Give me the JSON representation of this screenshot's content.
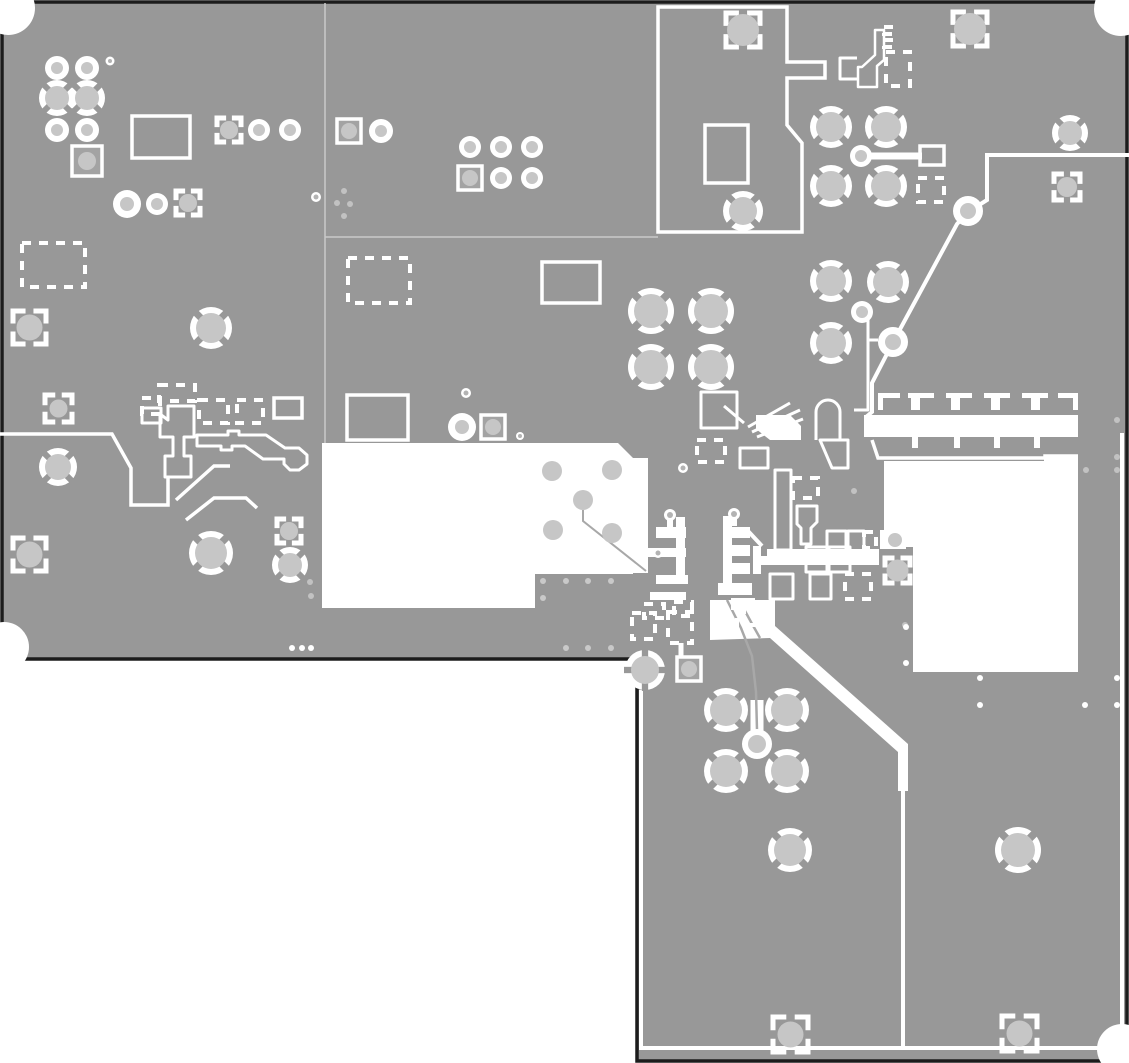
{
  "canvas": {
    "width": 1129,
    "height": 1063
  },
  "colors": {
    "background": "#ffffff",
    "copper": "#989898",
    "edge": "#1c1c1c",
    "white": "#ffffff",
    "padFill": "#c6c6c6",
    "squareFill": "#a3a3a3",
    "dotLight": "#c2c2c2",
    "blockDot": "#c9c9c9",
    "faintLine": "#c9c9c9",
    "grayTrace": "#a8a8a8"
  },
  "board": {
    "outline_path": "M2,2 H1127 V1061 H637 V659 H2 Z",
    "corner_cutouts": [
      {
        "x": 8,
        "y": 8,
        "r": 27
      },
      {
        "x": 1121,
        "y": 9,
        "r": 27
      },
      {
        "x": 4,
        "y": 647,
        "r": 25
      },
      {
        "x": 1122,
        "y": 1049,
        "r": 25
      }
    ],
    "faint_lines": [
      {
        "pts": [
          [
            325,
            3
          ],
          [
            325,
            443
          ]
        ],
        "w": 1.5
      },
      {
        "pts": [
          [
            325,
            237
          ],
          [
            658,
            237
          ]
        ],
        "w": 1.5
      }
    ]
  },
  "white_regions": [
    {
      "d": "M322,443 L618,443 L633,458 L648,458 L648,573 L633,573 L633,574 L535,574 L535,608 L322,608 Z"
    },
    {
      "d": "M884,461 L1044,461 L1044,457 L1078,457 L1078,672 L913,672 L913,547 L884,547 Z"
    },
    {
      "d": "M864,415 L1078,415 L1078,437 L864,437 Z"
    },
    {
      "d": "M710,600 L775,600 L775,626 L908,744 L908,791 L898,791 L898,752 L770,638 L710,640 Z"
    },
    {
      "d": "M756,415 L790,415 L801,426 L801,440 L770,440 L756,429 Z"
    },
    {
      "d": "M880,530 L906,530 L906,549 L880,549 Z"
    }
  ],
  "island_outline": {
    "d": "M658,7 H787 V62 H825 V78 H787 V125 L802,143 V232 H658 Z",
    "w": 3.5
  },
  "white_lines": [
    {
      "pts": [
        [
          868,
          156
        ],
        [
          922,
          156
        ]
      ],
      "w": 7
    },
    {
      "pts": [
        [
          1129,
          155
        ],
        [
          987,
          155
        ],
        [
          987,
          200
        ],
        [
          968,
          212
        ]
      ],
      "w": 4
    },
    {
      "pts": [
        [
          968,
          212
        ],
        [
          957,
          224
        ],
        [
          898,
          333
        ]
      ],
      "w": 4
    },
    {
      "pts": [
        [
          889,
          350
        ],
        [
          872,
          383
        ],
        [
          872,
          412
        ],
        [
          866,
          417
        ]
      ],
      "w": 4
    },
    {
      "pts": [
        [
          0,
          434
        ],
        [
          112,
          434
        ],
        [
          131,
          468
        ],
        [
          131,
          505
        ],
        [
          168,
          505
        ],
        [
          168,
          478
        ]
      ],
      "w": 3.5
    },
    {
      "pts": [
        [
          176,
          500
        ],
        [
          214,
          466
        ],
        [
          230,
          466
        ]
      ],
      "w": 3.5
    },
    {
      "pts": [
        [
          186,
          520
        ],
        [
          214,
          498
        ],
        [
          246,
          498
        ],
        [
          257,
          508
        ]
      ],
      "w": 3.5
    },
    {
      "pts": [
        [
          681,
          643
        ],
        [
          681,
          658
        ]
      ],
      "w": 5
    },
    {
      "pts": [
        [
          903,
          791
        ],
        [
          903,
          1048
        ]
      ],
      "w": 4
    },
    {
      "pts": [
        [
          641,
          690
        ],
        [
          641,
          1048
        ]
      ],
      "w": 4
    },
    {
      "pts": [
        [
          639,
          1048
        ],
        [
          1122,
          1048
        ]
      ],
      "w": 4
    },
    {
      "pts": [
        [
          1122,
          433
        ],
        [
          1122,
          1048
        ]
      ],
      "w": 4
    },
    {
      "pts": [
        [
          757,
          700
        ],
        [
          757,
          738
        ]
      ],
      "w": 13
    },
    {
      "pts": [
        [
          748,
          531
        ],
        [
          762,
          546
        ]
      ],
      "w": 4
    },
    {
      "pts": [
        [
          868,
          340
        ],
        [
          878,
          340
        ]
      ],
      "w": 3
    },
    {
      "pts": [
        [
          872,
          440
        ],
        [
          878,
          458
        ],
        [
          1045,
          458
        ],
        [
          1045,
          456
        ],
        [
          1078,
          456
        ]
      ],
      "w": 3.5
    }
  ],
  "gray_traces": [
    {
      "pts": [
        [
          583,
          510
        ],
        [
          583,
          521
        ],
        [
          646,
          571
        ]
      ],
      "w": 2
    },
    {
      "pts": [
        [
          727,
          600
        ],
        [
          741,
          628
        ],
        [
          752,
          656
        ],
        [
          756,
          692
        ],
        [
          757,
          730
        ]
      ],
      "w": 2.5
    },
    {
      "pts": [
        [
          739,
          600
        ],
        [
          751,
          622
        ],
        [
          760,
          638
        ]
      ],
      "w": 2.5
    }
  ],
  "outline_paths": [
    {
      "d": "M142,408 h19 v15 h-19 Z",
      "w": 3
    },
    {
      "d": "M160,414 L168,420 L168,406 L194,406 L194,437 L184,437 L184,456 L191,456 L191,477 L165,477 L165,456 L173,456 L173,437 L160,437 Z",
      "w": 3
    },
    {
      "d": "M197,435 L228,435 L228,431 L239,431 L239,435 L266,435 L285,448 L299,448 L307,455 L307,464 L299,470 L290,470 L284,464 L284,459 L263,459 L245,446 L232,446 L232,450 L221,450 L221,446 L197,446 Z",
      "w": 3
    },
    {
      "d": "M857,58 L840,58 L840,79 L857,79",
      "w": 3
    },
    {
      "d": "M858,87 L877,87 L877,66 L884,60 L884,30 L875,30 L875,55 L862,67 L858,67 Z",
      "w": 2.5
    },
    {
      "d": "M701,392 h36 v36 h-36 Z",
      "w": 3
    },
    {
      "d": "M816,440 V412 a12,12 0 0 1 24,0 V440",
      "w": 3
    },
    {
      "d": "M740,448 h28 v20 h-28 Z",
      "w": 3
    },
    {
      "d": "M775,470 h16 v80 h-16 Z",
      "w": 3
    },
    {
      "d": "M854,318 h14 v92 h-14",
      "w": 3
    },
    {
      "d": "M797,506 h20 v16 l-6,6 v16 h-10 v-16 l-4,-4 Z",
      "w": 3
    },
    {
      "d": "M827,531 h19 v23 h-19 Z",
      "w": 3
    },
    {
      "d": "M848,531 h16 v23 h-16 Z",
      "w": 3
    },
    {
      "d": "M806,547 h21 v25 h-21 Z",
      "w": 3
    },
    {
      "d": "M829,547 h21 v25 h-21 Z",
      "w": 3
    },
    {
      "d": "M810,574 h21 v25 h-21 Z",
      "w": 3
    },
    {
      "d": "M770,574 h23 v25 h-23 Z",
      "w": 3
    },
    {
      "d": "M748,427 L790,403",
      "w": 3
    },
    {
      "d": "M752,432 L800,410",
      "w": 3
    },
    {
      "d": "M757,437 L803,419",
      "w": 3
    },
    {
      "d": "M744,423 L724,406",
      "w": 3
    },
    {
      "d": "M820,440 L848,440 L848,468 L832,468 Z",
      "w": 3
    }
  ],
  "filled_white_rects": [
    [
      656,
      527,
      30,
      11
    ],
    [
      642,
      548,
      44,
      9
    ],
    [
      656,
      575,
      32,
      9
    ],
    [
      650,
      592,
      36,
      8
    ],
    [
      667,
      519,
      6,
      8
    ],
    [
      676,
      517,
      9,
      64
    ],
    [
      731,
      518,
      6,
      8
    ],
    [
      723,
      516,
      9,
      74
    ],
    [
      723,
      527,
      27,
      11
    ],
    [
      723,
      545,
      27,
      11
    ],
    [
      723,
      563,
      27,
      11
    ],
    [
      753,
      546,
      8,
      28
    ],
    [
      718,
      583,
      34,
      12
    ],
    [
      731,
      598,
      24,
      12
    ],
    [
      767,
      549,
      112,
      16
    ],
    [
      758,
      556,
      12,
      9
    ]
  ],
  "solid_rect_outlines": [
    [
      132,
      116,
      58,
      42
    ],
    [
      542,
      262,
      58,
      41
    ],
    [
      347,
      395,
      61,
      45
    ],
    [
      705,
      125,
      43,
      58
    ],
    [
      920,
      146,
      24,
      19
    ],
    [
      274,
      398,
      28,
      20
    ]
  ],
  "dashed_rects": [
    [
      22,
      243,
      63,
      44
    ],
    [
      348,
      258,
      62,
      45
    ],
    [
      159,
      385,
      36,
      16
    ],
    [
      142,
      398,
      18,
      16
    ],
    [
      199,
      400,
      29,
      23
    ],
    [
      237,
      400,
      26,
      23
    ],
    [
      918,
      178,
      26,
      24
    ],
    [
      886,
      52,
      24,
      34
    ],
    [
      697,
      440,
      28,
      22
    ],
    [
      793,
      478,
      25,
      20
    ],
    [
      845,
      574,
      26,
      25
    ],
    [
      632,
      613,
      23,
      26
    ],
    [
      668,
      612,
      24,
      31
    ],
    [
      644,
      604,
      20,
      14
    ],
    [
      674,
      602,
      18,
      14
    ],
    [
      737,
      612,
      20,
      13
    ],
    [
      864,
      532,
      12,
      16
    ],
    [
      884,
      27,
      9,
      7
    ],
    [
      884,
      40,
      9,
      7
    ]
  ],
  "comb_footprint": {
    "dash_segments": [
      [
        878,
        393,
        22,
        5
      ],
      [
        908,
        393,
        26,
        5
      ],
      [
        946,
        393,
        26,
        5
      ],
      [
        984,
        393,
        26,
        5
      ],
      [
        1022,
        393,
        26,
        5
      ],
      [
        1058,
        393,
        20,
        5
      ],
      [
        878,
        393,
        5,
        17
      ],
      [
        1073,
        393,
        5,
        17
      ]
    ],
    "teeth": [
      [
        911,
        397,
        9,
        13
      ],
      [
        951,
        397,
        9,
        13
      ],
      [
        991,
        397,
        9,
        13
      ],
      [
        1031,
        397,
        9,
        13
      ]
    ],
    "slots": [
      [
        912,
        437,
        6,
        11
      ],
      [
        954,
        437,
        6,
        11
      ],
      [
        994,
        437,
        6,
        11
      ],
      [
        1034,
        437,
        6,
        11
      ]
    ]
  },
  "region_gray_circles": [
    [
      552,
      471,
      10
    ],
    [
      612,
      470,
      10
    ],
    [
      583,
      500,
      10
    ],
    [
      553,
      530,
      10
    ],
    [
      612,
      533,
      10
    ],
    [
      895,
      540,
      7
    ]
  ],
  "thermal_vias": [
    {
      "x": 57,
      "y": 98,
      "r": 12,
      "rot": 45
    },
    {
      "x": 87,
      "y": 98,
      "r": 12,
      "rot": 45
    },
    {
      "x": 211,
      "y": 328,
      "r": 15,
      "rot": 45
    },
    {
      "x": 58,
      "y": 467,
      "r": 13,
      "rot": 45
    },
    {
      "x": 211,
      "y": 553,
      "r": 16,
      "rot": 45
    },
    {
      "x": 290,
      "y": 565,
      "r": 12,
      "rot": 45
    },
    {
      "x": 651,
      "y": 311,
      "r": 17,
      "rot": 45
    },
    {
      "x": 711,
      "y": 311,
      "r": 17,
      "rot": 45
    },
    {
      "x": 651,
      "y": 367,
      "r": 17,
      "rot": 45
    },
    {
      "x": 711,
      "y": 367,
      "r": 17,
      "rot": 45
    },
    {
      "x": 831,
      "y": 127,
      "r": 15,
      "rot": 45
    },
    {
      "x": 886,
      "y": 127,
      "r": 15,
      "rot": 45
    },
    {
      "x": 831,
      "y": 186,
      "r": 15,
      "rot": 45
    },
    {
      "x": 886,
      "y": 186,
      "r": 15,
      "rot": 45
    },
    {
      "x": 831,
      "y": 281,
      "r": 15,
      "rot": 45
    },
    {
      "x": 888,
      "y": 282,
      "r": 15,
      "rot": 45
    },
    {
      "x": 831,
      "y": 343,
      "r": 15,
      "rot": 45
    },
    {
      "x": 1070,
      "y": 133,
      "r": 12,
      "rot": 45
    },
    {
      "x": 743,
      "y": 211,
      "r": 14,
      "rot": 45
    },
    {
      "x": 645,
      "y": 670,
      "r": 14,
      "rot": 0
    },
    {
      "x": 726,
      "y": 710,
      "r": 16,
      "rot": 45
    },
    {
      "x": 787,
      "y": 710,
      "r": 16,
      "rot": 45
    },
    {
      "x": 726,
      "y": 771,
      "r": 16,
      "rot": 45
    },
    {
      "x": 787,
      "y": 771,
      "r": 16,
      "rot": 45
    },
    {
      "x": 790,
      "y": 850,
      "r": 16,
      "rot": 45
    },
    {
      "x": 1018,
      "y": 850,
      "r": 17,
      "rot": 45
    }
  ],
  "ring_pads": [
    [
      57,
      68,
      12,
      6
    ],
    [
      87,
      68,
      12,
      6
    ],
    [
      57,
      130,
      12,
      6
    ],
    [
      87,
      130,
      12,
      6
    ],
    [
      127,
      204,
      14,
      7
    ],
    [
      157,
      204,
      11,
      6
    ],
    [
      259,
      130,
      11,
      6
    ],
    [
      290,
      130,
      11,
      6
    ],
    [
      381,
      131,
      12,
      6
    ],
    [
      470,
      147,
      11,
      6
    ],
    [
      501,
      147,
      11,
      6
    ],
    [
      532,
      147,
      11,
      6
    ],
    [
      501,
      178,
      11,
      6
    ],
    [
      532,
      178,
      11,
      6
    ],
    [
      462,
      427,
      14,
      7
    ],
    [
      861,
      156,
      11,
      6
    ],
    [
      968,
      211,
      15,
      8
    ],
    [
      893,
      342,
      15,
      8
    ],
    [
      862,
      312,
      11,
      6
    ],
    [
      757,
      744,
      15,
      9
    ]
  ],
  "small_rings": [
    [
      110,
      61,
      4.5,
      2
    ],
    [
      316,
      197,
      5,
      2.5
    ],
    [
      466,
      393,
      5,
      2.5
    ],
    [
      520,
      436,
      4,
      2
    ],
    [
      683,
      468,
      5,
      2.5
    ],
    [
      658,
      553,
      5,
      2.5
    ],
    [
      670,
      515,
      6,
      3
    ],
    [
      734,
      514,
      6,
      3
    ]
  ],
  "square_pads_solid": [
    [
      72,
      146,
      30,
      9
    ],
    [
      337,
      119,
      24,
      8
    ],
    [
      458,
      166,
      24,
      8
    ],
    [
      481,
      415,
      24,
      8
    ],
    [
      677,
      657,
      24,
      8
    ]
  ],
  "bracket_pads": [
    [
      13,
      311,
      33,
      13
    ],
    [
      45,
      395,
      27,
      9
    ],
    [
      13,
      538,
      33,
      13
    ],
    [
      277,
      519,
      24,
      9
    ],
    [
      726,
      13,
      34,
      16
    ],
    [
      953,
      12,
      34,
      16
    ],
    [
      1054,
      174,
      26,
      10
    ],
    [
      885,
      558,
      25,
      11
    ],
    [
      773,
      1017,
      35,
      13
    ],
    [
      1002,
      1016,
      35,
      13
    ],
    [
      217,
      118,
      24,
      9
    ],
    [
      176,
      191,
      24,
      9
    ]
  ],
  "gray_dots": [
    [
      337,
      203
    ],
    [
      350,
      204
    ],
    [
      344,
      216
    ],
    [
      344,
      191
    ],
    [
      310,
      582
    ],
    [
      311,
      596
    ],
    [
      854,
      491
    ],
    [
      905,
      625
    ],
    [
      1086,
      470
    ],
    [
      1117,
      420
    ],
    [
      1117,
      457
    ],
    [
      1117,
      470
    ]
  ],
  "block_dots": [
    [
      543,
      581
    ],
    [
      566,
      581
    ],
    [
      588,
      581
    ],
    [
      611,
      581
    ],
    [
      543,
      598
    ],
    [
      566,
      648
    ],
    [
      588,
      648
    ],
    [
      611,
      648
    ]
  ],
  "white_dots": [
    [
      906,
      627
    ],
    [
      906,
      663
    ],
    [
      980,
      678
    ],
    [
      980,
      705
    ],
    [
      1085,
      705
    ],
    [
      1117,
      678
    ],
    [
      1117,
      705
    ],
    [
      292,
      648
    ],
    [
      302,
      648
    ],
    [
      311,
      648
    ]
  ]
}
